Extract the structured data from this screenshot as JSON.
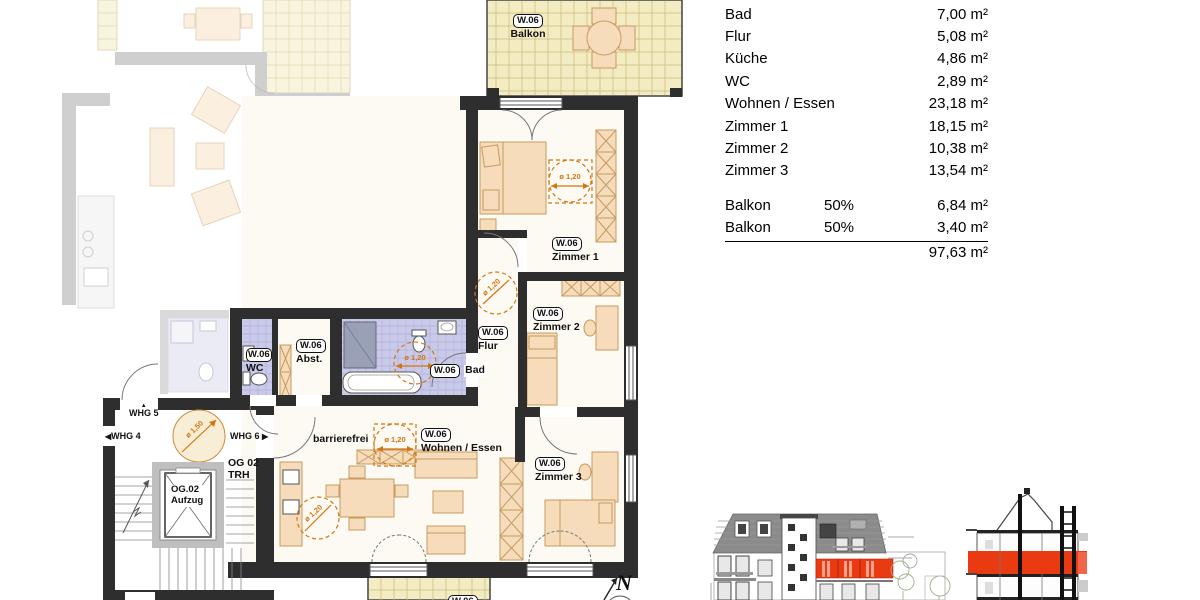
{
  "unit": "W.06",
  "plan": {
    "labels": {
      "balkon_top": "Balkon",
      "zimmer1": "Zimmer 1",
      "zimmer2": "Zimmer 2",
      "zimmer3": "Zimmer 3",
      "flur": "Flur",
      "abst": "Abst.",
      "wc": "WC",
      "bad": "Bad",
      "wohnen": "Wohnen / Essen",
      "barrierefrei": "barrierefrei",
      "og02_line1": "OG 02",
      "og02_line2": "TRH",
      "aufzug_line1": "OG.02",
      "aufzug_line2": "Aufzug",
      "whg4": "WHG 4",
      "whg5": "WHG 5",
      "whg6": "WHG 6",
      "north": "N"
    },
    "annotations": {
      "dia_120": "ø 1,20",
      "dia_150": "ø 1,50"
    },
    "icons": {
      "arrow_left": "◀",
      "arrow_right": "▶",
      "arrow_up": "▲"
    }
  },
  "area_table": {
    "rows": [
      {
        "label": "Bad",
        "value": "7,00 m²"
      },
      {
        "label": "Flur",
        "value": "5,08 m²"
      },
      {
        "label": "Küche",
        "value": "4,86 m²"
      },
      {
        "label": "WC",
        "value": "2,89 m²"
      },
      {
        "label": "Wohnen / Essen",
        "value": "23,18 m²"
      },
      {
        "label": "Zimmer 1",
        "value": "18,15 m²"
      },
      {
        "label": "Zimmer 2",
        "value": "10,38 m²"
      },
      {
        "label": "Zimmer 3",
        "value": "13,54 m²"
      }
    ],
    "balcony_rows": [
      {
        "label": "Balkon",
        "factor": "50%",
        "value": "6,84 m²"
      },
      {
        "label": "Balkon",
        "factor": "50%",
        "value": "3,40 m²"
      }
    ],
    "total": "97,63 m²"
  },
  "colors": {
    "wall_dark": "#2e2e2e",
    "wall_faded": "#a9a9a9",
    "balcony_tile": "#f3ecc3",
    "bath_tile": "#c9c9e9",
    "furniture": "#f6dcba",
    "furniture_stroke": "#c79a60",
    "accent_orange": "#d4760f",
    "highlight_red": "#e93a12",
    "roof_gray": "#8b8b8b"
  }
}
